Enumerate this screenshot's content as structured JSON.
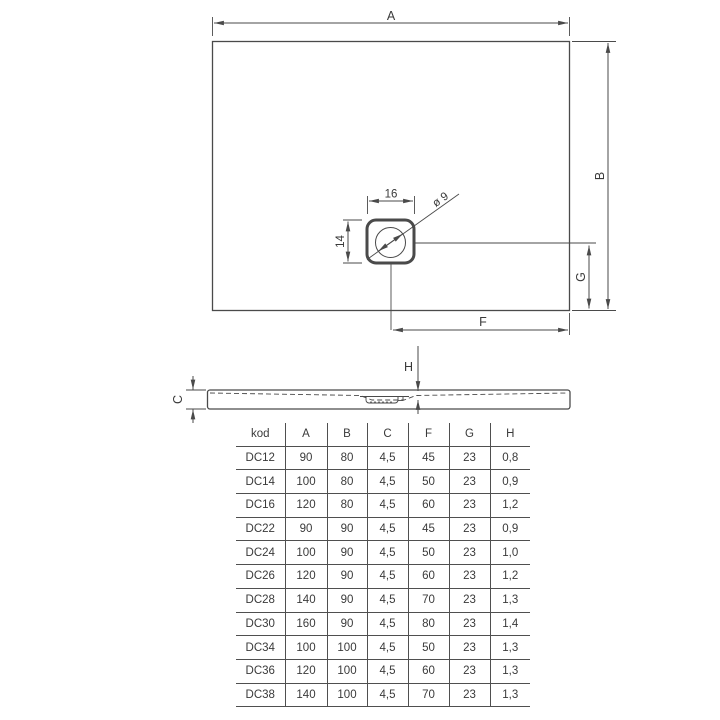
{
  "drawing": {
    "plan": {
      "label_a": "A",
      "label_b": "B",
      "label_f": "F",
      "label_g": "G",
      "drain_width_label": "16",
      "drain_height_label": "14",
      "drain_diameter_label": "ø 9"
    },
    "profile": {
      "label_h": "H",
      "label_c": "C"
    }
  },
  "table": {
    "headers": [
      "kod",
      "A",
      "B",
      "C",
      "F",
      "G",
      "H"
    ],
    "rows": [
      [
        "DC12",
        "90",
        "80",
        "4,5",
        "45",
        "23",
        "0,8"
      ],
      [
        "DC14",
        "100",
        "80",
        "4,5",
        "50",
        "23",
        "0,9"
      ],
      [
        "DC16",
        "120",
        "80",
        "4,5",
        "60",
        "23",
        "1,2"
      ],
      [
        "DC22",
        "90",
        "90",
        "4,5",
        "45",
        "23",
        "0,9"
      ],
      [
        "DC24",
        "100",
        "90",
        "4,5",
        "50",
        "23",
        "1,0"
      ],
      [
        "DC26",
        "120",
        "90",
        "4,5",
        "60",
        "23",
        "1,2"
      ],
      [
        "DC28",
        "140",
        "90",
        "4,5",
        "70",
        "23",
        "1,3"
      ],
      [
        "DC30",
        "160",
        "90",
        "4,5",
        "80",
        "23",
        "1,4"
      ],
      [
        "DC34",
        "100",
        "100",
        "4,5",
        "50",
        "23",
        "1,3"
      ],
      [
        "DC36",
        "120",
        "100",
        "4,5",
        "60",
        "23",
        "1,3"
      ],
      [
        "DC38",
        "140",
        "100",
        "4,5",
        "70",
        "23",
        "1,3"
      ]
    ]
  },
  "colors": {
    "line": "#4a4a4a",
    "text": "#3a3a3a",
    "background": "#ffffff"
  }
}
